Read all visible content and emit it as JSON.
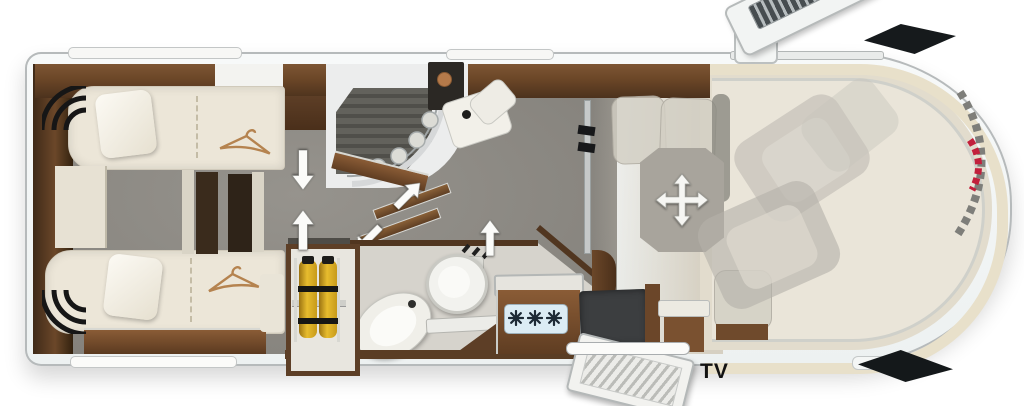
{
  "diagram": {
    "type": "motorhome-floorplan-top-view",
    "labels": {
      "tv": "TV"
    },
    "rooms": [
      {
        "name": "rear-twin-bedroom",
        "contents": [
          "single-bed-top",
          "single-bed-bottom",
          "center-steps",
          "wardrobe-hangers"
        ]
      },
      {
        "name": "shower-room",
        "contents": [
          "shower-tray",
          "curved-glass-door"
        ]
      },
      {
        "name": "washroom",
        "contents": [
          "toilet",
          "washbasin",
          "vanity-counter"
        ]
      },
      {
        "name": "kitchen",
        "contents": [
          "gas-hob-3-burner",
          "worktop"
        ]
      },
      {
        "name": "gas-bottle-locker",
        "contents": [
          "gas-bottle",
          "gas-bottle"
        ]
      },
      {
        "name": "living-dinette",
        "contents": [
          "movable-table",
          "bench-seats",
          "tv-sideboard"
        ]
      },
      {
        "name": "cab",
        "contents": [
          "swivel-seat-driver",
          "swivel-seat-passenger",
          "windshield"
        ]
      }
    ],
    "counts": {
      "gas_burners": 3,
      "gas_bottles": 2,
      "single_beds": 2,
      "cab_seats": 2,
      "hangers": 2,
      "open_doors": 2
    },
    "icons": {
      "hanger-icon": "clothes hanger = wardrobe",
      "move-arrows-icon": "4-way arrows = table slides in all directions",
      "direction-arrow-icon": "white arrow = sliding / walk-through direction",
      "swing-arrow-icon": "diagonal arrows = pivoting partition door",
      "gas-burner-icon": "star burner symbol on hob"
    },
    "colors": {
      "body_shell": "#f2f5f5",
      "carpet_gray": "#8b8882",
      "wood_dark": "#5d3e26",
      "upholstery_cream": "#ece6d8",
      "windshield_band": "#e8e0ca",
      "hob_panel_blue": "#dcecf4",
      "gas_bottle_yellow": "#dfb42a",
      "accent_red": "#c2203c",
      "mirror_black": "#14181a"
    }
  }
}
